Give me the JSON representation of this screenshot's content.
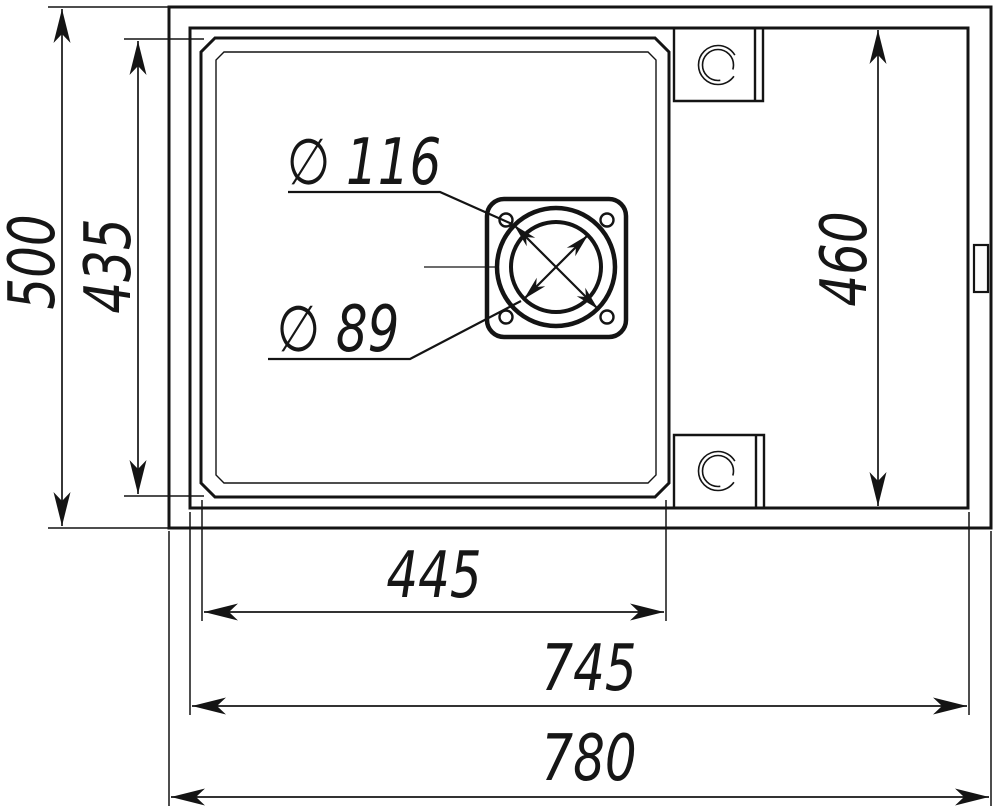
{
  "drawing": {
    "title": "Sink technical drawing, top view",
    "units": "mm",
    "colors": {
      "line": "#141414",
      "background": "#ffffff"
    },
    "dimensions": {
      "overall_width": "780",
      "overall_depth": "500",
      "rim_width": "745",
      "rim_depth": "460",
      "bowl_width": "445",
      "bowl_depth": "435",
      "drain_outer_diameter": "∅ 116",
      "drain_inner_diameter": "∅ 89"
    }
  }
}
